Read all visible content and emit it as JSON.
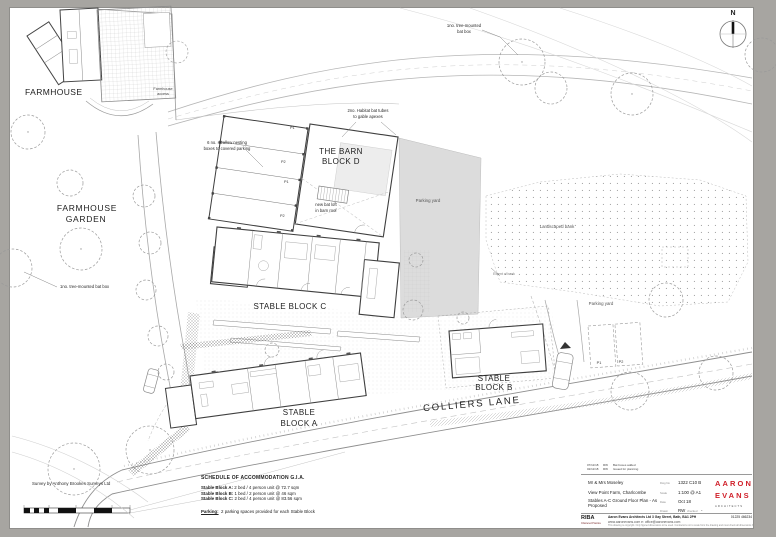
{
  "plan": {
    "north_label": "N",
    "labels": {
      "farmhouse": "FARMHOUSE",
      "farmhouse_access_1": "Farmhouse",
      "farmhouse_access_2": "access",
      "farmhouse_garden_1": "FARMHOUSE",
      "farmhouse_garden_2": "GARDEN",
      "barn_1": "THE BARN",
      "barn_2": "BLOCK D",
      "stable_c": "STABLE BLOCK C",
      "stable_a_1": "STABLE",
      "stable_a_2": "BLOCK A",
      "stable_b_1": "STABLE",
      "stable_b_2": "BLOCK B",
      "colliers_lane": "COLLIERS LANE",
      "parking_yard_main": "Parking yard",
      "parking_yard_right": "Parking yard",
      "landscaped_bank": "Landscaped bank",
      "extent_note": "Extent of bank"
    },
    "annotations": {
      "tree_bat_top_1": "1no. tree-mounted",
      "tree_bat_top_2": "bat box",
      "tree_bat_left": "1no. tree-mounted bat box",
      "swallow_1": "6 no. swallow nesting",
      "swallow_2": "boxes to covered parking",
      "bat_tubes_1": "2no. Habitat bat tubes",
      "bat_tubes_2": "to gable apexes",
      "bat_loft_1": "new bat loft",
      "bat_loft_2": "in barn roof",
      "survey": "Survey by Anthony Brookes Surveys Ltd"
    },
    "parking_bays_barn": [
      "P1",
      "P2",
      "P1",
      "P2"
    ],
    "parking_bays_right": [
      "P1",
      "P2"
    ]
  },
  "schedule": {
    "title": "SCHEDULE OF ACCOMMODATION G.I.A.",
    "rows": [
      {
        "name": "Stable Block A:",
        "desc": "2 bed / 4 person unit @ 72.7 sqm"
      },
      {
        "name": "Stable Block B:",
        "desc": "1 bed / 2 person unit @ 46 sqm"
      },
      {
        "name": "Stable Block C:",
        "desc": "2 bed / 4 person unit @ 83.56 sqm"
      }
    ],
    "parking_label": "Parking:",
    "parking_desc": "2 parking spaces provided for each Stable Block"
  },
  "titleblock": {
    "revisions": [
      {
        "date": "07/11/18",
        "by": "RW",
        "desc": "Bat boxes added"
      },
      {
        "date": "02/11/18",
        "by": "RW",
        "desc": "Issued for planning"
      }
    ],
    "client": "Mr & Mrs Moseley",
    "project": "View Point Farm, Charlcombe",
    "drawing": "Stables A-C Ground Floor Plan - As Proposed",
    "dwg_no_label": "Dwg No",
    "dwg_no": "1322 C10 B",
    "scale_label": "Scale",
    "scale": "1:100 @ A1",
    "date_label": "Date",
    "date": "Oct 18",
    "drawn_label": "Drawn",
    "drawn": "RW",
    "checked_label": "checked",
    "checked": "-",
    "logo": {
      "line1": "AARON",
      "line2": "EVANS",
      "line3": "ARCHITECTS"
    },
    "riba": "RIBA",
    "riba_sub": "Chartered Practice",
    "address": "Aaron Evans Architects Ltd   3 Gay Street, Bath, BA1 2PH",
    "contact": "www.aaronevans.com   e: office@aaronevans.com",
    "phone": "01225 466234",
    "copyright": "This drawing is copyright. Only figured dimensions to be used. Contractors not to scale from the drawing and must check all dimensions before proceeding."
  },
  "colors": {
    "sheet": "#ffffff",
    "surround": "#a7a5a1",
    "parking_yard_fill": "#dcdcdc",
    "logo_red": "#d0202a"
  }
}
